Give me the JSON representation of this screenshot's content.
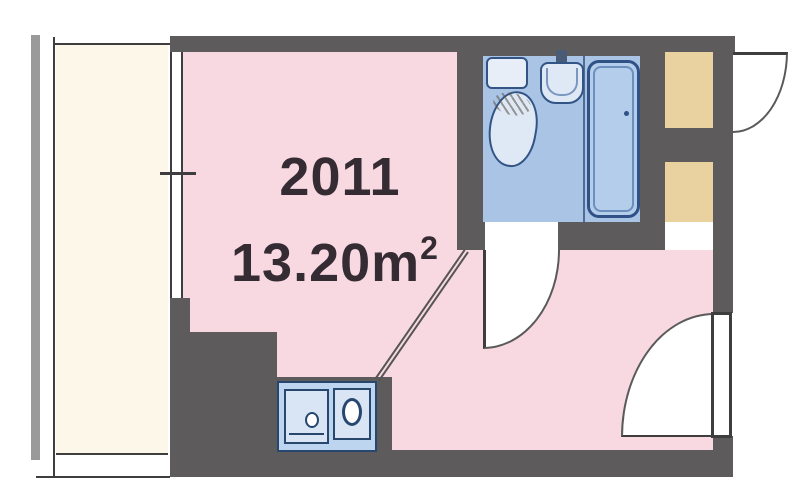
{
  "floor_plan": {
    "unit_number": "2011",
    "area_value": "13.20m",
    "area_exponent": "2"
  },
  "rooms": {
    "main_room": "living room",
    "bathroom": "unit bathroom",
    "balcony": "balcony",
    "kitchen": "kitchenette",
    "closets": "storage / pipe space"
  },
  "icons": {
    "toilet": "toilet-icon",
    "sink": "sink-icon",
    "bathtub": "bathtub-icon",
    "kitchen_sink": "kitchen-sink-icon",
    "stove_burner": "stove-burner-icon",
    "door_arcs": "door-swing-arc"
  },
  "colors": {
    "wall": "#5d5b5c",
    "room_pink": "#f8d9e2",
    "bathroom_blue": "#a9c4e4",
    "kitchen_blue": "#bdd5ef",
    "closet_beige": "#e9d29f",
    "balcony_cream": "#fdf7e9",
    "fixture_outline": "#335585",
    "text_color": "#352b33"
  }
}
